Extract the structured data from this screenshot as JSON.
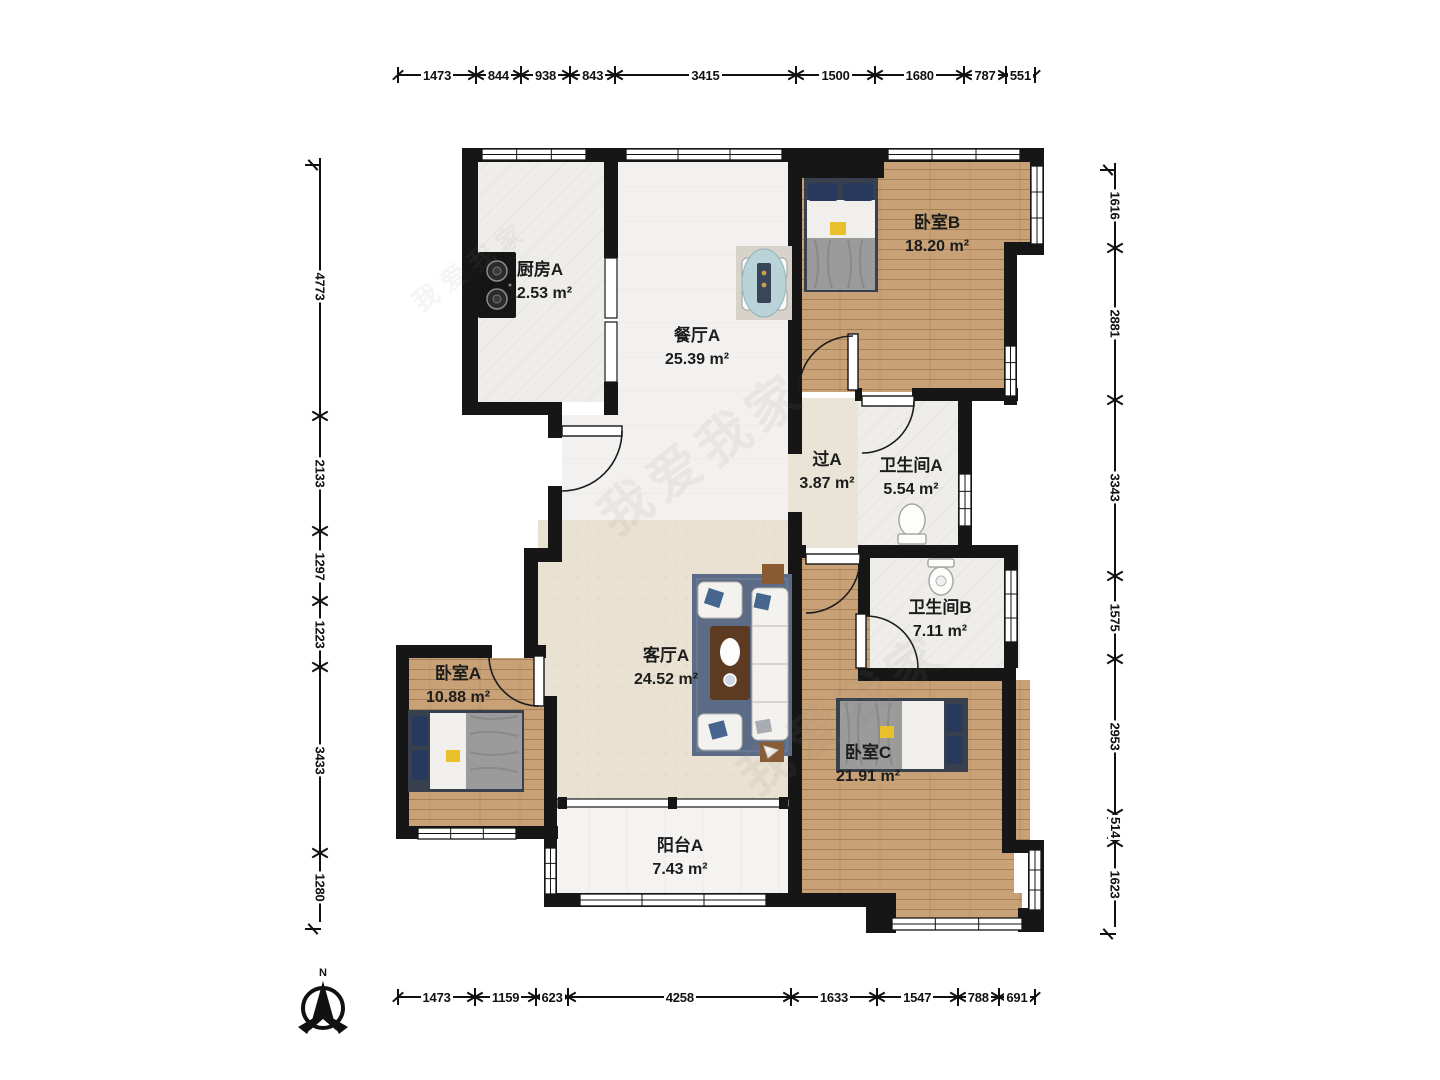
{
  "compass": {
    "label": "N"
  },
  "watermark": {
    "text": "我爱我家"
  },
  "rooms": {
    "kitchen": {
      "name": "厨房A",
      "area": "12.53 m²"
    },
    "dining": {
      "name": "餐厅A",
      "area": "25.39 m²"
    },
    "bedroomB": {
      "name": "卧室B",
      "area": "18.20 m²"
    },
    "corridor": {
      "name": "过A",
      "area": "3.87 m²"
    },
    "bathroomA": {
      "name": "卫生间A",
      "area": "5.54 m²"
    },
    "bathroomB": {
      "name": "卫生间B",
      "area": "7.11 m²"
    },
    "living": {
      "name": "客厅A",
      "area": "24.52 m²"
    },
    "bedroomA": {
      "name": "卧室A",
      "area": "10.88 m²"
    },
    "bedroomC": {
      "name": "卧室C",
      "area": "21.91 m²"
    },
    "balcony": {
      "name": "阳台A",
      "area": "7.43 m²"
    }
  },
  "dimensions": {
    "top": [
      1473,
      844,
      938,
      843,
      3415,
      1500,
      1680,
      787,
      551
    ],
    "bottom": [
      1473,
      1159,
      623,
      4258,
      1633,
      1547,
      788,
      691
    ],
    "left": [
      4773,
      2133,
      1297,
      1223,
      3433,
      1280
    ],
    "right": [
      1616,
      2881,
      3343,
      1575,
      2953,
      514,
      1623
    ]
  },
  "colors": {
    "wall": "#161616",
    "wood_floor": "#c9a176",
    "living_floor": "#e9e1d1",
    "dining_floor": "#f2f1ef",
    "tile_floor": "#efedea",
    "balcony_floor": "#f4f3f1",
    "rug": "#5d6c86",
    "bed_pillow": "#27395c",
    "accent_yellow": "#e8c02a"
  }
}
